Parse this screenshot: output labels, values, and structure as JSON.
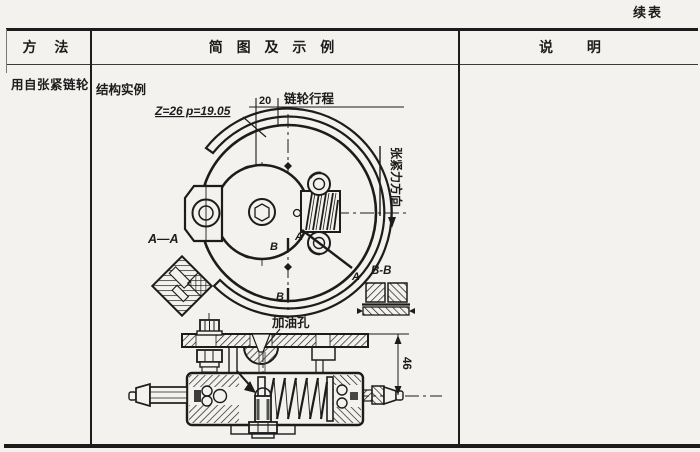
{
  "page": {
    "continued": "续表"
  },
  "table": {
    "col_method": "方 法",
    "col_diagram": "简 图 及 示 例",
    "col_note": "说 明",
    "method": "用自张紧链轮"
  },
  "drawing": {
    "example": "结构实例",
    "spec": "Z=26 p=19.05",
    "dim20": "20",
    "stroke_label": "链轮行程",
    "force_label": "张紧力方向",
    "a1": "A",
    "a2": "A",
    "b1": "B",
    "b2": "B",
    "section_aa": "A—A",
    "section_bb": "B-B",
    "oil_hole": "加油孔",
    "dim46": "46"
  },
  "colors": {
    "paper": "#f3f2ee",
    "ink": "#1c1c1c"
  }
}
